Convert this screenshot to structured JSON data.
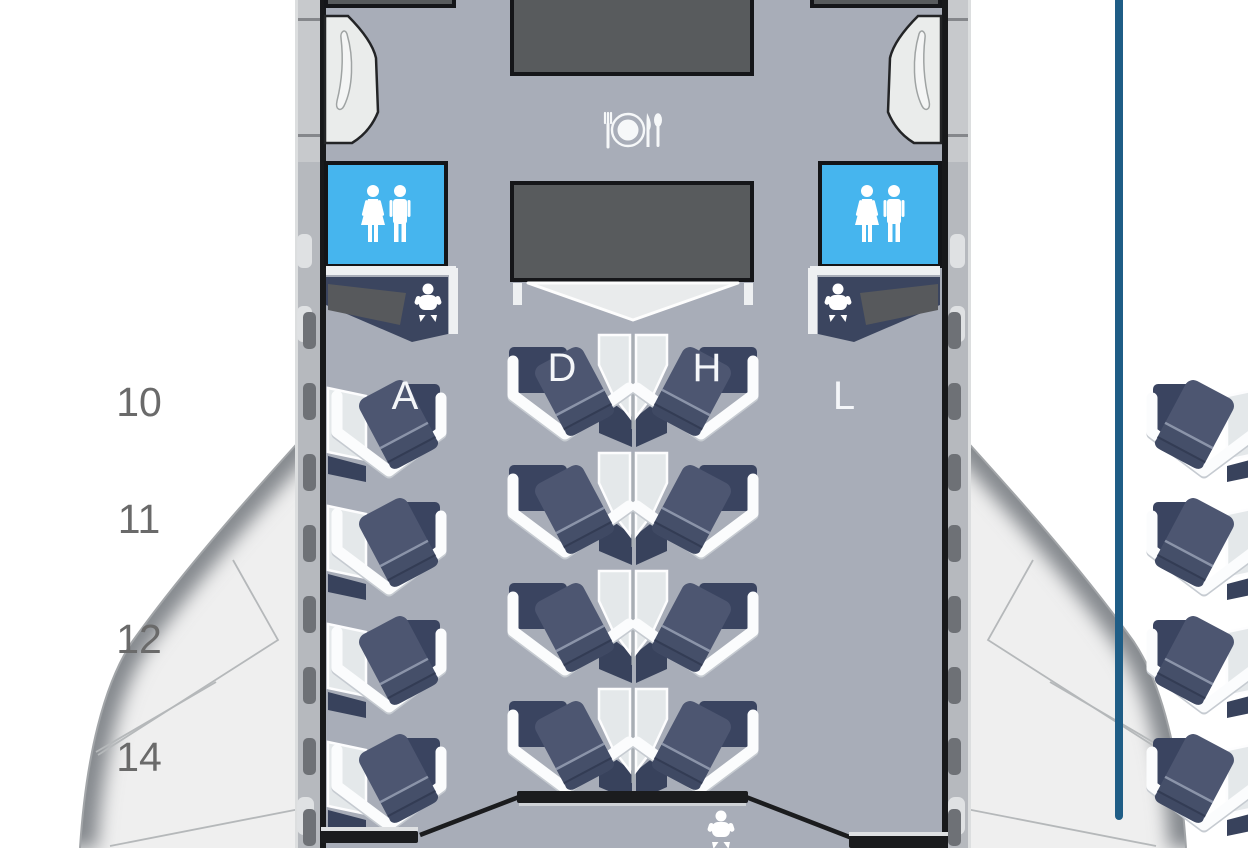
{
  "seat_map": {
    "row_labels": [
      "10",
      "11",
      "12",
      "14"
    ],
    "columns": [
      "A",
      "D",
      "H",
      "L"
    ],
    "rows": [
      {
        "row": "10",
        "seats": [
          "10A",
          "10D",
          "10H",
          "10L"
        ]
      },
      {
        "row": "11",
        "seats": [
          "11A",
          "11D",
          "11H",
          "11L"
        ]
      },
      {
        "row": "12",
        "seats": [
          "12A",
          "12D",
          "12H",
          "12L"
        ]
      },
      {
        "row": "14",
        "seats": [
          "14A",
          "14D",
          "14H",
          "14L"
        ]
      }
    ]
  },
  "icons": {
    "dining": "dining-icon",
    "lavatory": "lavatory-icon",
    "baby_changing": "baby-changing-icon"
  },
  "colors": {
    "lavatory_blue": "#46b5ee",
    "seat_cushion": "#4d5671",
    "seat_shell": "#fbfcfd",
    "floor": "#a8adb8",
    "galley": "#585b5d",
    "indicator_line": "#1f5d86"
  }
}
